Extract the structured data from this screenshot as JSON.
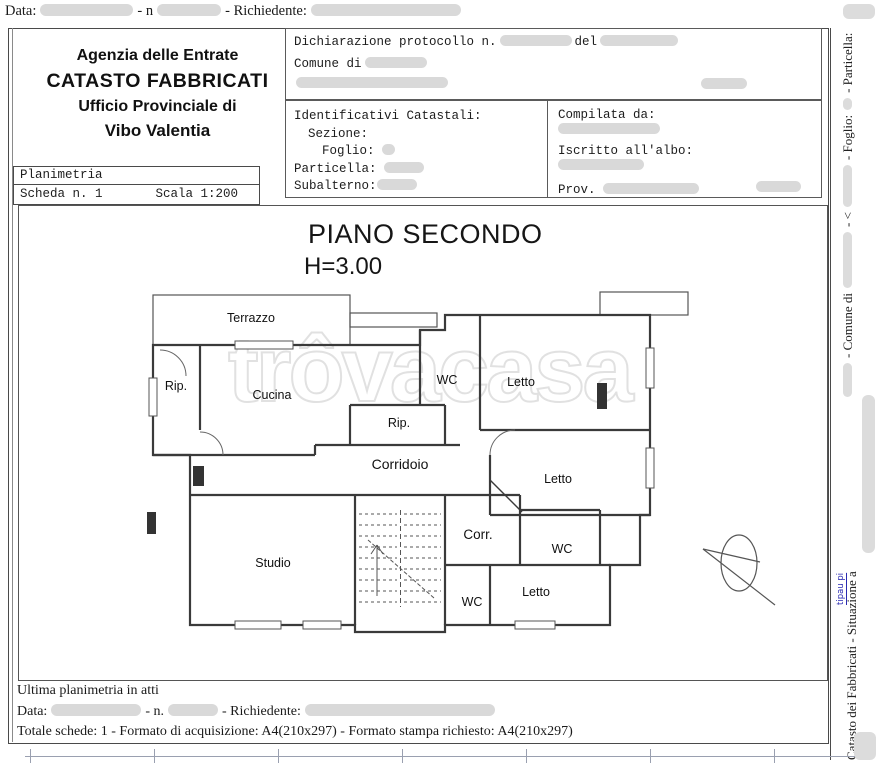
{
  "colors": {
    "redaction": "#d9d9d9",
    "wall": "#3a3a3a",
    "watermark_stroke": "#dcdcdc",
    "blue_note": "#2a2ab2"
  },
  "top_line": {
    "data": "Data:",
    "n": "- n",
    "richiedente": "- Richiedente:"
  },
  "agency": {
    "line1": "Agenzia delle Entrate",
    "line2": "CATASTO FABBRICATI",
    "line3": "Ufficio Provinciale di",
    "line4": "Vibo Valentia"
  },
  "declaration": {
    "protocollo": "Dichiarazione protocollo n.",
    "del": "del",
    "comune": "Comune di"
  },
  "identificativi": {
    "title": "Identificativi Catastali:",
    "sezione": "Sezione:",
    "foglio": "Foglio:",
    "particella": "Particella:",
    "subalterno": "Subalterno:"
  },
  "compilata": {
    "title": "Compilata da:",
    "iscritto": "Iscritto all'albo:",
    "prov": "Prov."
  },
  "planimetria": {
    "title": "Planimetria",
    "scheda": "Scheda n. 1",
    "scala": "Scala 1:200"
  },
  "plan": {
    "title": "PIANO SECONDO",
    "altezza": "H=3.00",
    "watermark": "trôvacasa",
    "labels": [
      "Terrazzo",
      "Rip.",
      "Cucina",
      "WC",
      "Letto",
      "Rip.",
      "Corridoio",
      "Letto",
      "Corr.",
      "WC",
      "Studio",
      "WC",
      "Letto"
    ]
  },
  "sidebar": {
    "particella": "- Particella:",
    "foglio": "- Foglio:",
    "angle": "- <",
    "comune": "- Comune di",
    "catasto": "Catasto dei Fabbricati - Situazione a",
    "note": "tipau pi"
  },
  "footer": {
    "ultima": "Ultima planimetria in atti",
    "data": "Data:",
    "n": "- n.",
    "richiedente": "- Richiedente:",
    "totale": "Totale schede: 1 - Formato di acquisizione: A4(210x297)  - Formato stampa richiesto: A4(210x297)"
  }
}
